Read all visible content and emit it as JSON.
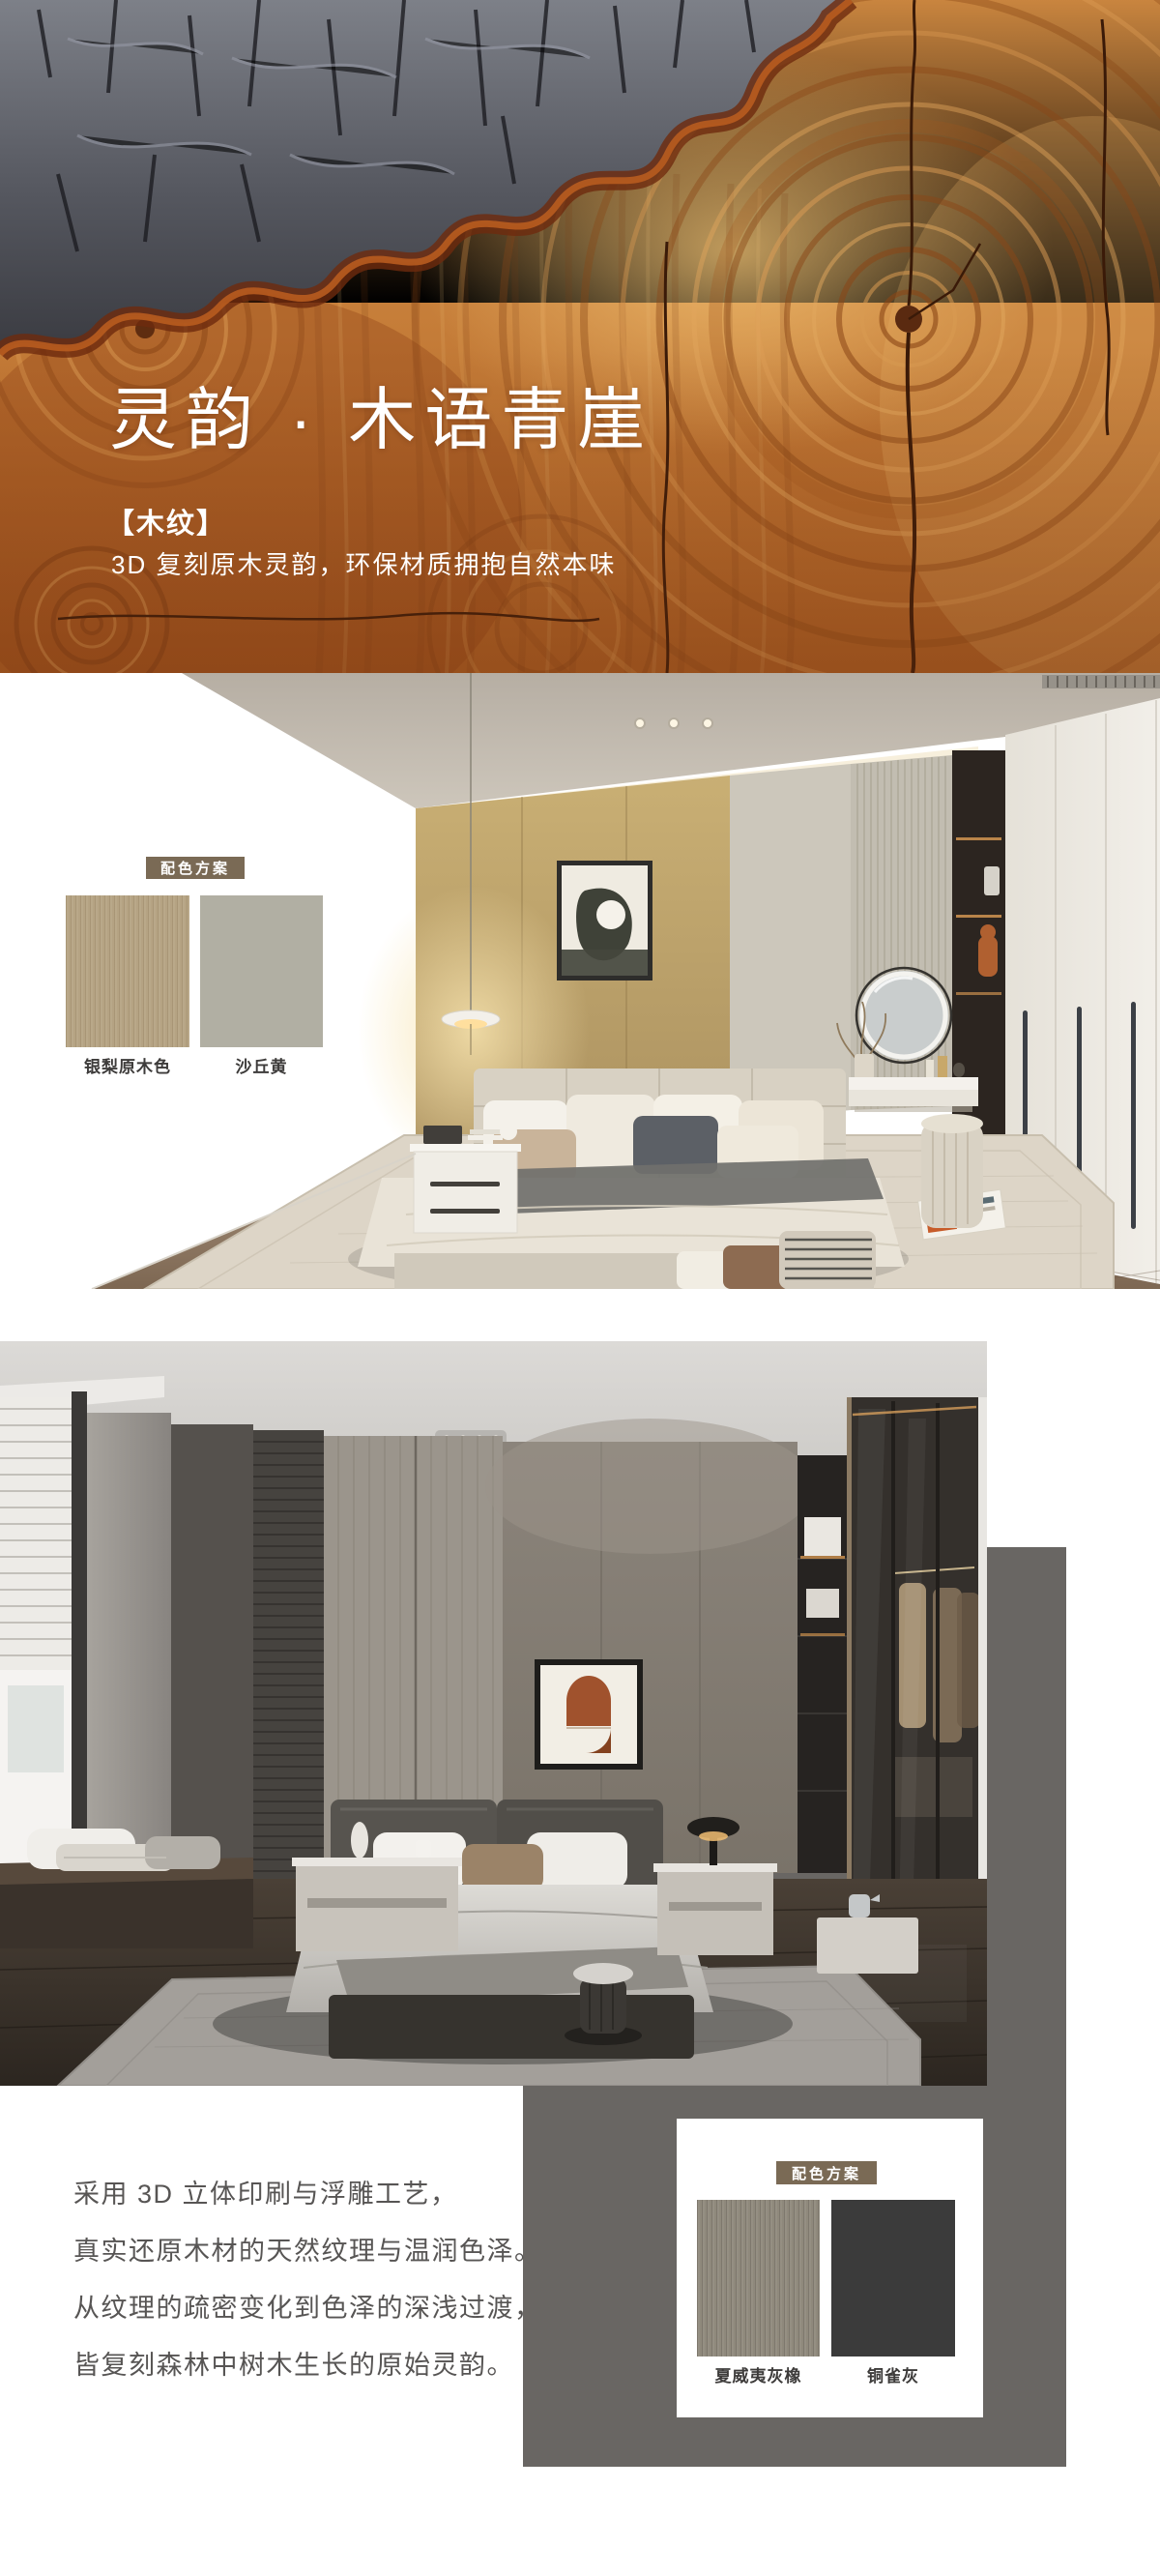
{
  "hero": {
    "title": "灵韵 · 木语青崖",
    "tag": "【木纹】",
    "subtitle": "3D 复刻原木灵韵，环保材质拥抱自然本味"
  },
  "scheme_light": {
    "badge": "配色方案",
    "swatches": [
      {
        "name": "银梨原木色",
        "color": "#b5a383"
      },
      {
        "name": "沙丘黄",
        "color": "#b1afa3"
      }
    ]
  },
  "scheme_dark": {
    "badge": "配色方案",
    "swatches": [
      {
        "name": "夏威夷灰橡",
        "color": "#8f897c"
      },
      {
        "name": "铜雀灰",
        "color": "#3b3b3b"
      }
    ]
  },
  "description": {
    "lines": [
      "采用 3D 立体印刷与浮雕工艺，",
      "真实还原木材的天然纹理与温润色泽。",
      "从纹理的疏密变化到色泽的深浅过渡，",
      "皆复刻森林中树木生长的原始灵韵。"
    ]
  },
  "colors": {
    "badge_bg": "#7a6a55",
    "backdrop": "#696663",
    "text": "#575554"
  }
}
